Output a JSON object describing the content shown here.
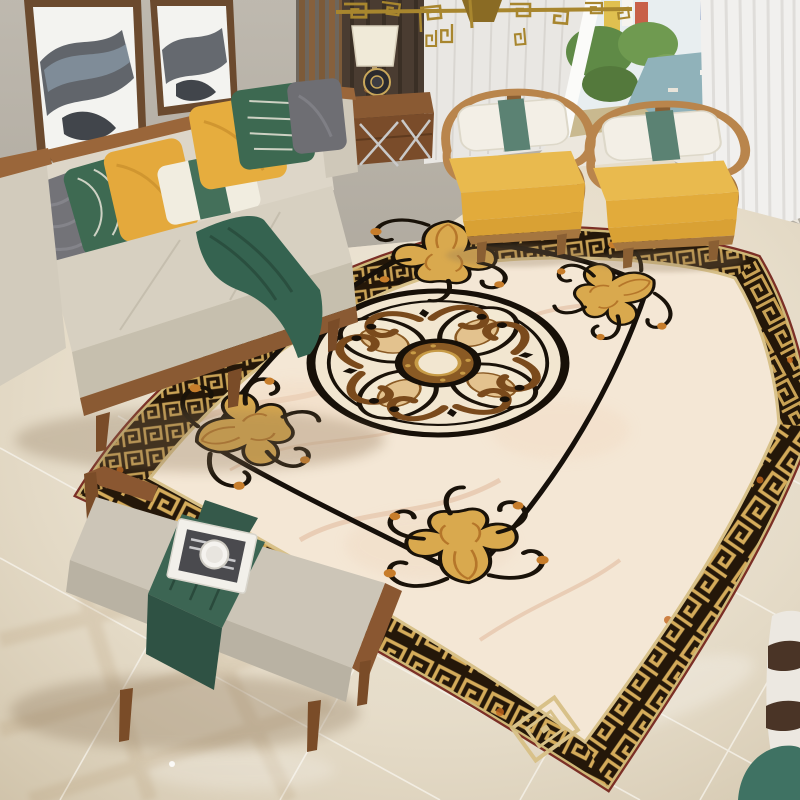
{
  "meta": {
    "type": "product-photo",
    "description": "Living room scene: beige fabric sofa with yellow, green, white and gray pillows at left under two abstract ink paintings; two wooden hoop-arm armchairs with yellow cushions by a bright window with white sheer curtains; gold geometric chandelier; wooden bench with gray cushion, green runner, magazine and white cup; large classical area rug with black-and-gold Greek key border, cream marble field, golden corner scroll ornaments and a round golden medallion, on glossy beige marble tile floor."
  },
  "palette": {
    "wall": "#b7b1a7",
    "wall_light": "#ece7dd",
    "curtain_dark": "#4a3c31",
    "curtain_sheer": "#e9e7e3",
    "curtain_white": "#f1f0ee",
    "window_sky": "#e8eef0",
    "window_green": "#5f8a46",
    "window_water": "#90b2ba",
    "floor": "#e6ddcb",
    "grout": "#f8f5ee",
    "rug_field": "#f4e7d5",
    "rug_band": "#241709",
    "rug_gold": "#c9a255",
    "rug_bevel": "#d8c189",
    "rug_edge": "#7b2f26",
    "rug_line": "#16100a",
    "orn_gold": "#d9a94e",
    "orn_amber": "#c77d2b",
    "med_cream": "#f2e6d0",
    "med_brown": "#8a5a24",
    "sofa_wood": "#9a663a",
    "sofa_fabric": "#d7d0c1",
    "pillow_gray": "#737378",
    "pillow_green": "#3e6a52",
    "pillow_yellow": "#e4a93c",
    "pillow_cream": "#f1ede0",
    "throw_green": "#356350",
    "chair_wood": "#b9854c",
    "chair_cushion": "#e9ba4e",
    "chair_pillow": "#f3efe6",
    "chair_band": "#5b8273",
    "bench_wood": "#8a5731",
    "bench_cushion": "#ccc5b7",
    "runner_green": "#3c6553",
    "book_white": "#f2f0ea",
    "frame_wood": "#6b4a2e",
    "art_ink": "#3c414a",
    "chandelier_gold": "#a8862e",
    "table_wood": "#8a5a33",
    "lamp_shade": "#f0ead8",
    "stool_white": "#ece8e1",
    "stool_dark": "#4a3426",
    "pot_green": "#3f7263"
  }
}
